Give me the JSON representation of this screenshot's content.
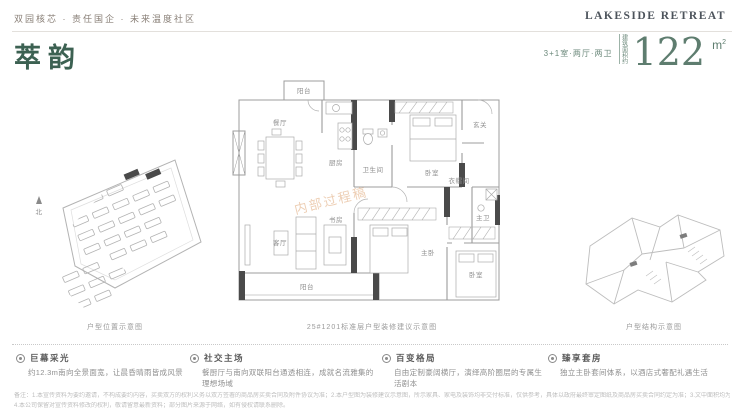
{
  "header": {
    "tagline": "双园核芯 · 责任国企 · 未来温度社区",
    "logo": "LAKESIDE RETREAT"
  },
  "title": {
    "name": "萃韵",
    "layout": "3+1室·两厅·两卫",
    "area_label": "建筑面积约",
    "area_value": "122",
    "area_unit_base": "m"
  },
  "diagrams": {
    "site_caption": "户型位置示意图",
    "plan_caption": "25#1201标准层户型装修建议示意图",
    "structure_caption": "户型结构示意图",
    "watermark": "内部过程稿",
    "compass": "北"
  },
  "floorplan": {
    "rooms": {
      "north_balcony": "阳台",
      "kitchen": "厨房",
      "dining": "餐厅",
      "bath": "卫生间",
      "bedroom2": "卧室",
      "entry": "玄关",
      "cloakroom": "衣帽间",
      "master_bath": "主卫",
      "living": "客厅",
      "study": "书房",
      "master": "主卧",
      "bedroom3": "卧室",
      "south_balcony": "阳台"
    }
  },
  "features": [
    {
      "title": "巨幕采光",
      "desc": "约12.3m南向全景面宽，让晨昏晴雨皆成风景"
    },
    {
      "title": "社交主场",
      "desc": "餐厨厅与南向双联阳台通透相连，成就名流雅集的理想场域"
    },
    {
      "title": "百变格局",
      "desc": "自由定制豪阔横厅，演绎高阶圈层的专属生活剧本"
    },
    {
      "title": "臻享套房",
      "desc": "独立主卧套间体系，以酒店式奢配礼遇生活"
    }
  ],
  "disclaimer": {
    "line1": "备注：1.本宣传资料为要约邀请，不构成要约内容，买卖双方的权利义务以双方签署的商品房买卖合同及附件协议为准；2.本户型图为装修建议示意图，所示家具、家电及装饰均非交付标准，仅供参考，具体以政府最终审定图纸及商品房买卖合同约定为准；3.文中面积均为建筑面积，实际以不动产权证登记面积为准；",
    "line2": "4.本公司保留对宣传资料修改的权利，敬请留意最新资料；部分图片来源于网络，如有侵权请联系删除。"
  },
  "colors": {
    "accent_green": "#3c6152",
    "number_green": "#5e7d6f",
    "watermark_orange": "#dc9f6b",
    "wall_dark": "#4a4a4a"
  }
}
